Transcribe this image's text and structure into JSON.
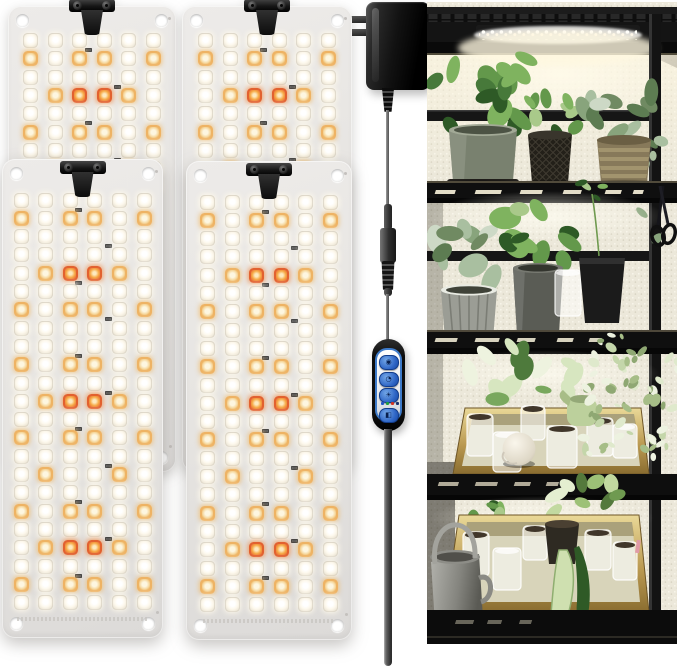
{
  "product_scene": {
    "kind": "led-grow-light-product-photo",
    "panel_count": 4,
    "visible_text": ""
  },
  "palette": {
    "panel_gray": "#e7e5e2",
    "led_white": "#fdf8ec",
    "led_warm": "#eeb364",
    "led_red": "#e2612f",
    "clip_black": "#161616",
    "adapter_black": "#121212",
    "cable_gray": "#6e6e6e",
    "controller_blue": "#3d7ac9",
    "button_blue": "#2c63c4",
    "indicator_blue": "#2456c8",
    "indicator_green": "#1f9e3f",
    "indicator_red": "#d03222",
    "photo_wall": "#ece8da",
    "shelf_black": "#141414",
    "glow_warm": "#fff6dd",
    "tray_gold": "#b3924a",
    "leaf_green": "#47793a",
    "watering_can_gray": "#9a9a94"
  },
  "panels": {
    "led_columns": 6,
    "legend": {
      "W": "white LED",
      "A": "warm-white LED",
      "R": "red LED"
    },
    "back_rows": [
      "WWWWWW",
      "AWAAWA",
      "WWWWWW",
      "WARRAW",
      "WWWWWW",
      "AWAAWA",
      "WWWWWW",
      "WAWWAW",
      "WWWWWW"
    ],
    "front_rows": [
      "WWWWWW",
      "AWAAWA",
      "WWWWWW",
      "WWWWWW",
      "WARRAW",
      "WWWWWW",
      "AWAAWA",
      "WWWWWW",
      "WWWWWW",
      "AWAAWA",
      "WWWWWW",
      "WARRAW",
      "WWWWWW",
      "AWAAWA",
      "WWWWWW",
      "WAWWAW",
      "WWWWWW",
      "AWAAWA",
      "WWWWWW",
      "WARRAW",
      "WWWWWW",
      "AWAAWA",
      "WWWWWW"
    ],
    "instances": [
      {
        "id": "back-left",
        "type": "back"
      },
      {
        "id": "back-right",
        "type": "back"
      },
      {
        "id": "front-left",
        "type": "front"
      },
      {
        "id": "front-right",
        "type": "front"
      }
    ]
  },
  "adapter": {
    "kind": "wall-plug-power-adapter",
    "prongs": 2
  },
  "controller": {
    "buttons": [
      {
        "name": "power-button",
        "glyph": "◉"
      },
      {
        "name": "timer-button",
        "glyph": "◔"
      },
      {
        "name": "brightness-button",
        "glyph": "☀"
      },
      {
        "name": "spectrum-button",
        "glyph": "◧"
      }
    ],
    "indicators": [
      "#2456c8",
      "#1f9e3f",
      "#d03222",
      "#15306e"
    ]
  },
  "photo": {
    "shelf_levels": 5,
    "potted_plants": 6,
    "seedling_trays": 2,
    "seedling_cups": 11,
    "items": [
      "wire-shelf-rack",
      "under-shelf-grow-light",
      "pothos-plants",
      "silver-pothos",
      "seedling-tray",
      "clear-plastic-cups",
      "humidity-dome-ball",
      "watering-can",
      "pruning-scissors",
      "variegated-bush"
    ]
  }
}
